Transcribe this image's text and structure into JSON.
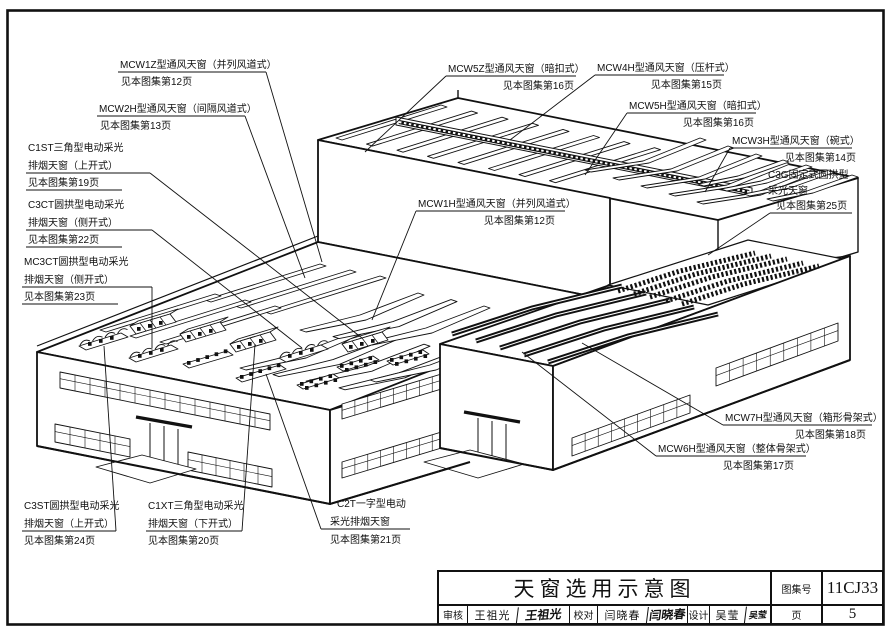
{
  "sheet": {
    "kind_label": "天窗选用示意图"
  },
  "drawing": {
    "callouts": [
      {
        "id": "mcw1z",
        "lines": [
          "MCW1Z型通风天窗（并列风道式）"
        ],
        "page": "见本图集第12页"
      },
      {
        "id": "mcw2h",
        "lines": [
          "MCW2H型通风天窗（间隔风道式）"
        ],
        "page": "见本图集第13页"
      },
      {
        "id": "c1st",
        "lines": [
          "C1ST三角型电动采光",
          "排烟天窗（上开式）"
        ],
        "page": "见本图集第19页"
      },
      {
        "id": "c3ct",
        "lines": [
          "C3CT圆拱型电动采光",
          "排烟天窗（侧开式）"
        ],
        "page": "见本图集第22页"
      },
      {
        "id": "mc3ct",
        "lines": [
          "MC3CT圆拱型电动采光",
          "排烟天窗（侧开式）"
        ],
        "page": "见本图集第23页"
      },
      {
        "id": "mcw5z",
        "lines": [
          "MCW5Z型通风天窗（暗扣式）"
        ],
        "page": "见本图集第16页"
      },
      {
        "id": "mcw4h",
        "lines": [
          "MCW4H型通风天窗（压杆式）"
        ],
        "page": "见本图集第15页"
      },
      {
        "id": "mcw5h",
        "lines": [
          "MCW5H型通风天窗（暗扣式）"
        ],
        "page": "见本图集第16页"
      },
      {
        "id": "mcw3h",
        "lines": [
          "MCW3H型通风天窗（碗式）"
        ],
        "page": "见本图集第14页"
      },
      {
        "id": "c3g",
        "lines": [
          "C3G固定式圆拱型",
          "采光天窗"
        ],
        "page": "见本图集第25页"
      },
      {
        "id": "mcw1h",
        "lines": [
          "MCW1H型通风天窗（并列风道式）"
        ],
        "page": "见本图集第12页"
      },
      {
        "id": "mcw7h",
        "lines": [
          "MCW7H型通风天窗（箱形骨架式）"
        ],
        "page": "见本图集第18页"
      },
      {
        "id": "mcw6h",
        "lines": [
          "MCW6H型通风天窗（整体骨架式）"
        ],
        "page": "见本图集第17页"
      },
      {
        "id": "c3st",
        "lines": [
          "C3ST圆拱型电动采光",
          "排烟天窗（上开式）"
        ],
        "page": "见本图集第24页"
      },
      {
        "id": "c1xt",
        "lines": [
          "C1XT三角型电动采光",
          "排烟天窗（下开式）"
        ],
        "page": "见本图集第20页"
      },
      {
        "id": "c2t",
        "lines": [
          "C2T一字型电动",
          "采光排烟天窗"
        ],
        "page": "见本图集第21页"
      }
    ]
  },
  "title_block": {
    "title": "天窗选用示意图",
    "atlas_no_label": "图集号",
    "atlas_no": "11CJ33",
    "page_label": "页",
    "page_no": "5",
    "reviewer_label": "审核",
    "reviewer": "王祖光",
    "reviewer_signature": "王祖光",
    "checker_label": "校对",
    "checker": "闫晓春",
    "checker_signature": "闫晓春",
    "designer_label": "设计",
    "designer": "吴莹",
    "designer_signature": "吴莹"
  },
  "colors": {
    "line": "#111111",
    "background": "#ffffff"
  }
}
